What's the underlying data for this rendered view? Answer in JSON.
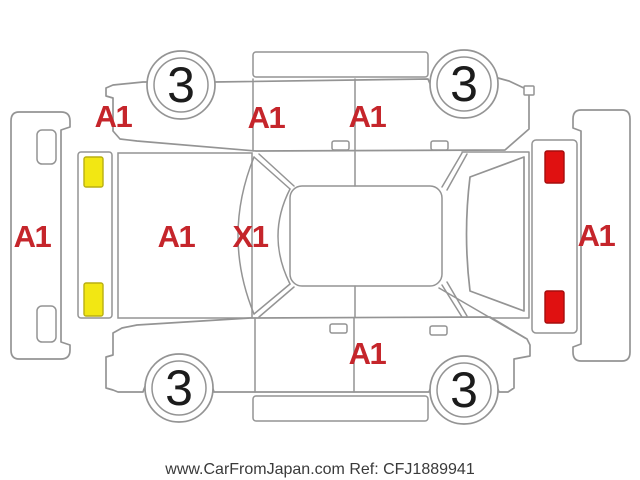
{
  "diagram": {
    "line_color": "#949494",
    "label_color": "#c5252b",
    "wheel_digit_color": "#1c1c1c",
    "marker_yellow": {
      "fill": "#f2e713",
      "stroke": "#b9af12"
    },
    "marker_red": {
      "fill": "#e01111",
      "stroke": "#a50d0d"
    },
    "wheels": [
      {
        "name": "front-left",
        "value": "3"
      },
      {
        "name": "front-right",
        "value": "3"
      },
      {
        "name": "rear-left",
        "value": "3"
      },
      {
        "name": "rear-right",
        "value": "3"
      }
    ],
    "codes": {
      "left_front_fender": "A1",
      "left_front_door": "A1",
      "left_rear_door": "A1",
      "front_bumper": "A1",
      "hood": "A1",
      "windshield": "X1",
      "rear_bumper": "A1",
      "right_side": "A1"
    }
  },
  "watermark": {
    "text": "www.CarFromJapan.com Ref: CFJ1889941",
    "color": "#3a3a3a"
  }
}
